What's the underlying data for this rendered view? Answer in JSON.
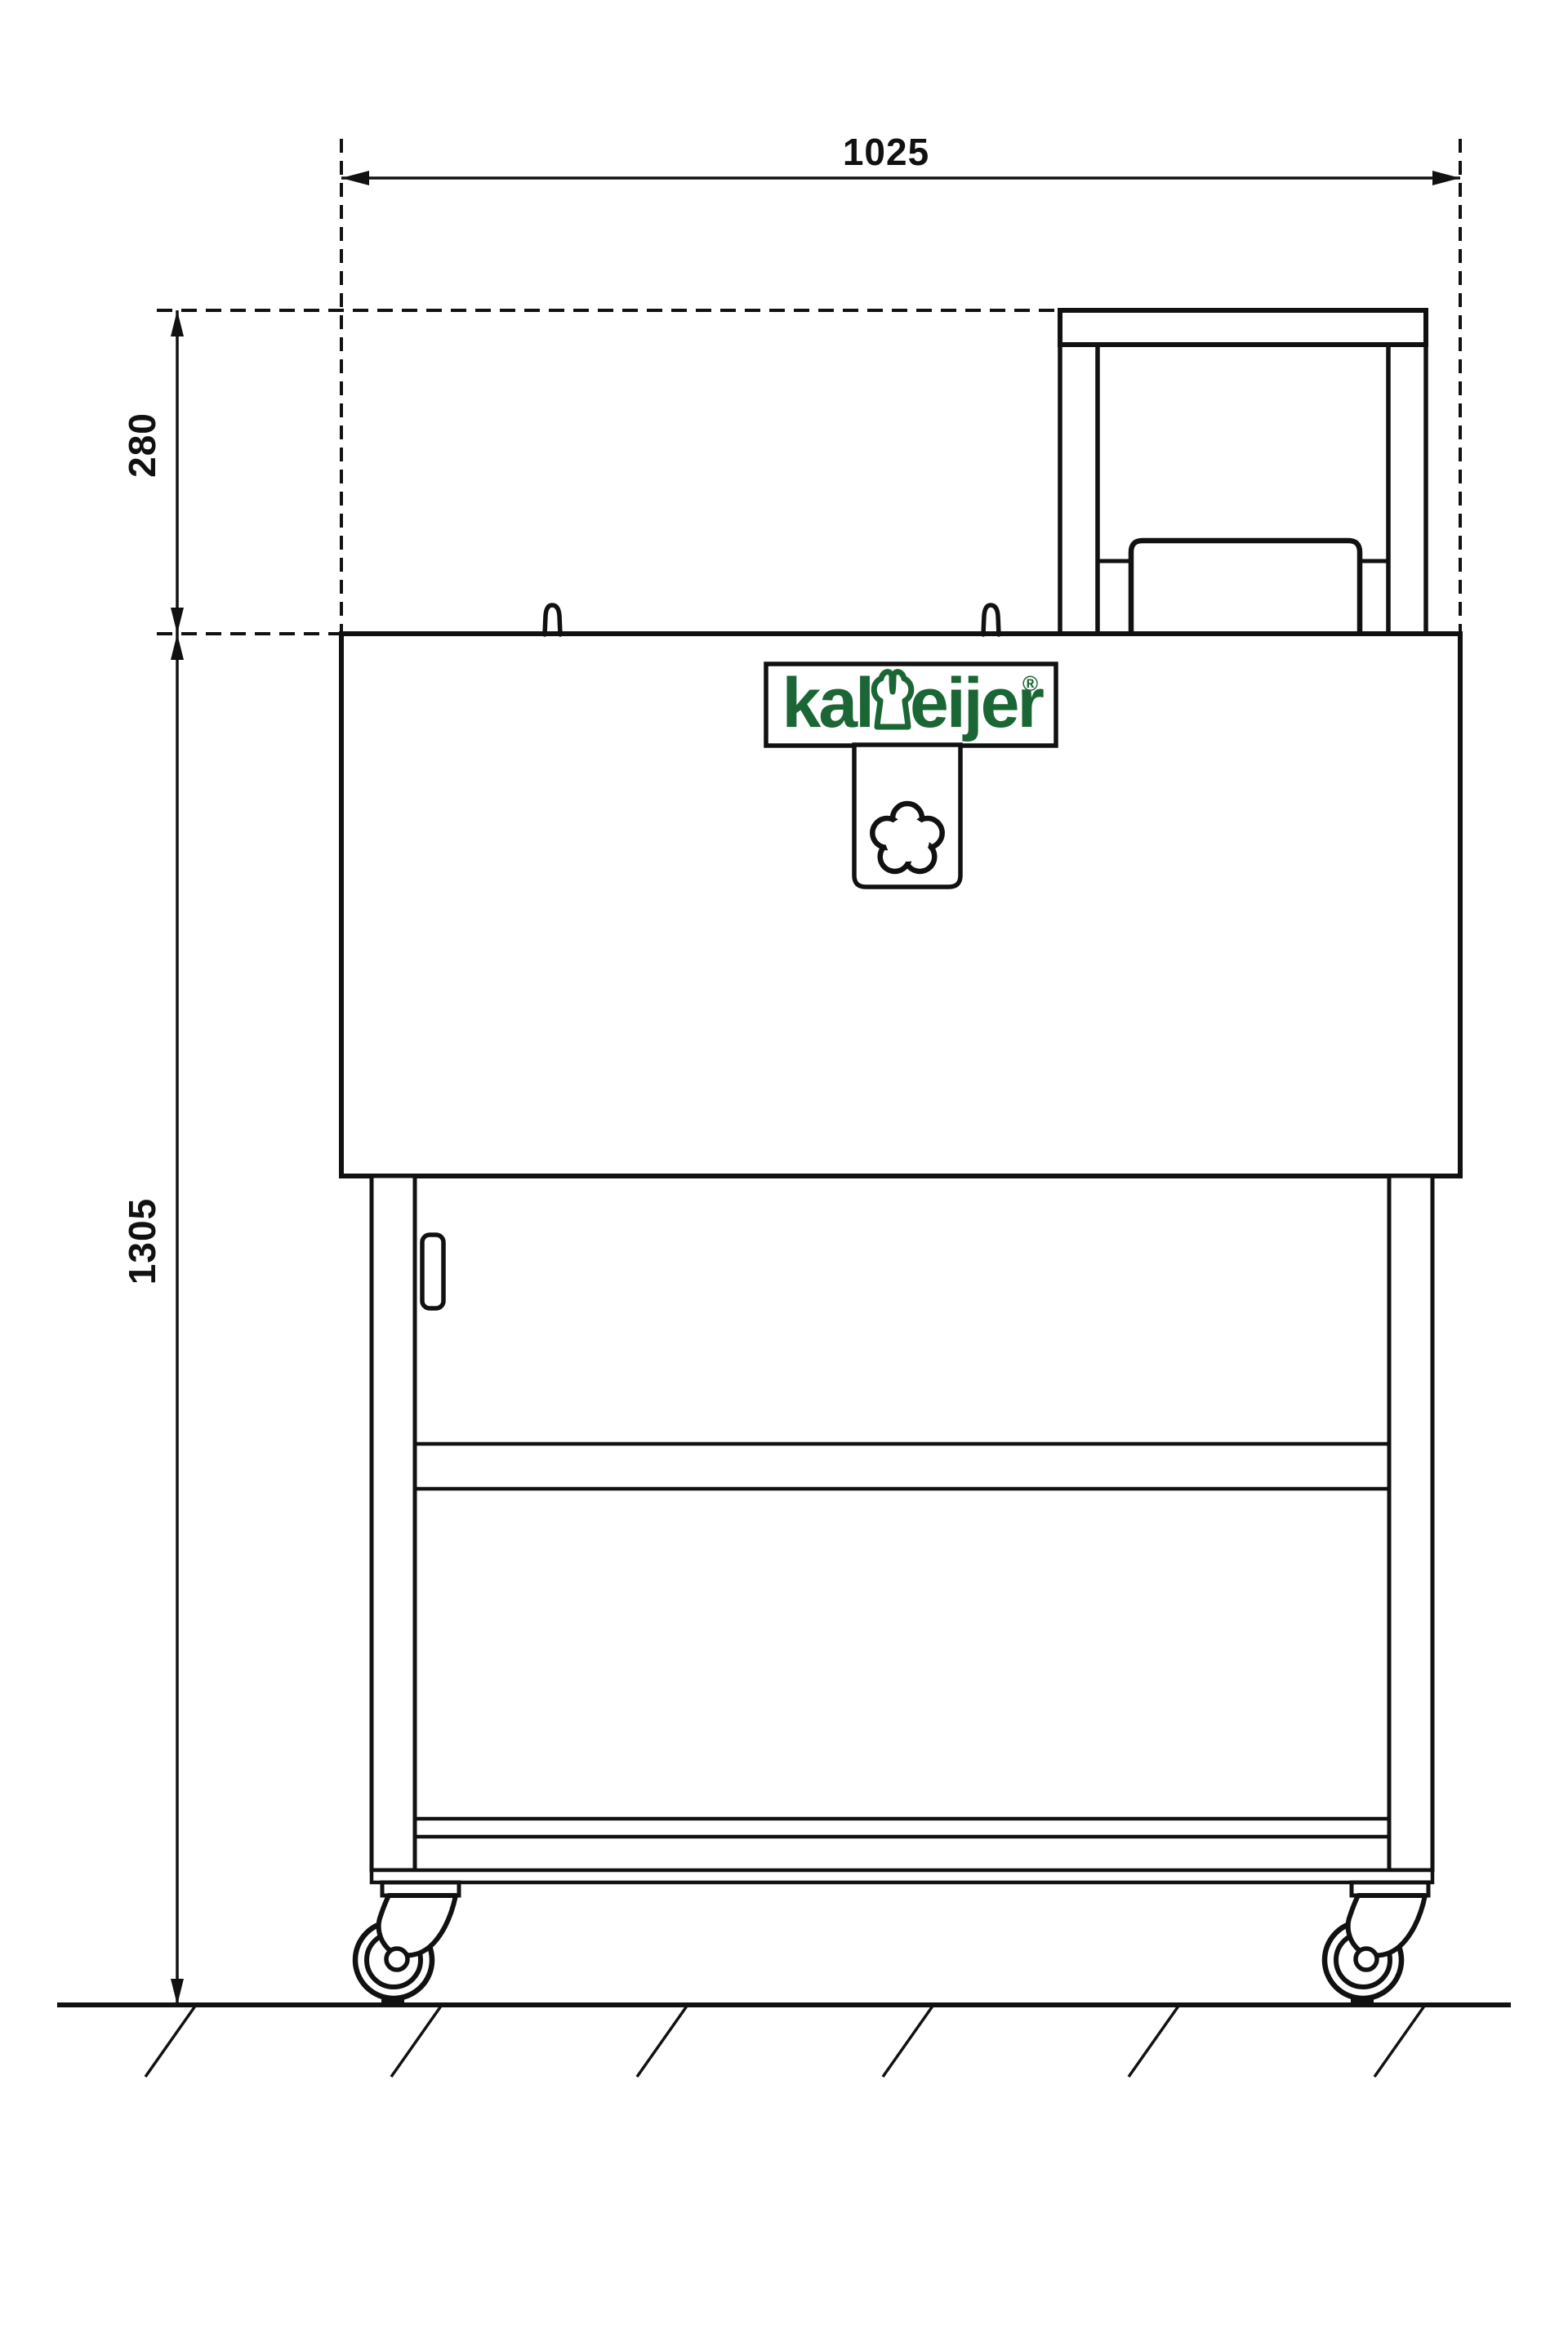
{
  "colors": {
    "background": "#ffffff",
    "ink": "#111111",
    "logo_green": "#1a6634"
  },
  "drawing": {
    "view": "front elevation technical drawing of kalmeijer cookie machine on swivel casters",
    "units_shown": "none (mm implied)"
  },
  "dimensions": {
    "width": {
      "value": "1025",
      "orientation": "horizontal",
      "position": "top"
    },
    "upper_height": {
      "value": "280",
      "orientation": "vertical",
      "position": "left-upper"
    },
    "total_height": {
      "value": "1305",
      "orientation": "vertical",
      "position": "left-lower"
    }
  },
  "logo": {
    "text_before_icon": "kal",
    "icon": "chef-hat-icon",
    "text_after_icon": "eijer",
    "registered_mark": "®"
  },
  "icons": {
    "knob": "star-knob-icon",
    "caster_left": "swivel-caster-icon",
    "caster_right": "swivel-caster-icon",
    "hooks": "mounting-hook-icon"
  }
}
